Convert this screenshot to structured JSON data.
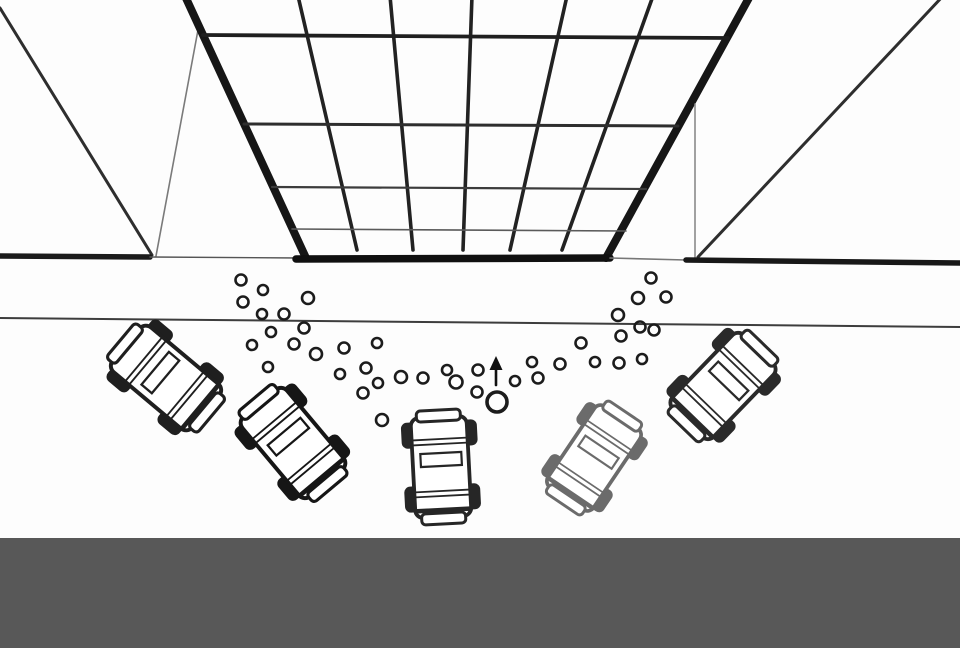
{
  "scene": {
    "background": "#fdfdfd",
    "floor": {
      "name": "floor-band",
      "x": 0,
      "y": 538,
      "w": 960,
      "h": 110,
      "color": "#585858"
    },
    "wall_lines": [
      {
        "name": "left-outer-wall-edge",
        "x1": 0,
        "y1": 8,
        "x2": 152,
        "y2": 255,
        "w": 3,
        "c": "#2e2e2e"
      },
      {
        "name": "left-inner-wall-edge",
        "x1": 198,
        "y1": 30,
        "x2": 156,
        "y2": 256,
        "w": 1.6,
        "c": "#7a7a7a"
      },
      {
        "name": "left-pillar",
        "x1": 185,
        "y1": -4,
        "x2": 306,
        "y2": 258,
        "w": 8,
        "c": "#161616"
      },
      {
        "name": "right-pillar",
        "x1": 750,
        "y1": -4,
        "x2": 606,
        "y2": 258,
        "w": 8,
        "c": "#161616"
      },
      {
        "name": "right-outer-wall-edge",
        "x1": 943,
        "y1": -4,
        "x2": 698,
        "y2": 257,
        "w": 3,
        "c": "#2e2e2e"
      },
      {
        "name": "right-inner-wall-edge",
        "x1": 695,
        "y1": 104,
        "x2": 695,
        "y2": 258,
        "w": 1.6,
        "c": "#8a8a8a"
      }
    ],
    "ceiling_grid": {
      "vertical_style": {
        "w": 3.6,
        "c": "#222222"
      },
      "verticals": [
        [
          298,
          -4,
          357,
          250
        ],
        [
          390,
          -4,
          413,
          250
        ],
        [
          472,
          -4,
          463,
          250
        ],
        [
          567,
          -4,
          510,
          250
        ],
        [
          653,
          -4,
          562,
          250
        ]
      ],
      "horizontals": [
        {
          "name": "ceiling-crossbar-1",
          "x1": 203,
          "y1": 35,
          "x2": 728,
          "y2": 38,
          "w": 3.8,
          "c": "#1f1f1f"
        },
        {
          "name": "ceiling-crossbar-2",
          "x1": 244,
          "y1": 124,
          "x2": 678,
          "y2": 126,
          "w": 3,
          "c": "#2e2e2e"
        },
        {
          "name": "ceiling-crossbar-3",
          "x1": 272,
          "y1": 187,
          "x2": 646,
          "y2": 189,
          "w": 2.2,
          "c": "#3c3c3c"
        },
        {
          "name": "ceiling-crossbar-4",
          "x1": 292,
          "y1": 229,
          "x2": 626,
          "y2": 231,
          "w": 1.6,
          "c": "#5a5a5a"
        }
      ]
    },
    "track_lines": [
      {
        "name": "start-wall-left",
        "x1": 0,
        "y1": 256,
        "x2": 150,
        "y2": 257,
        "w": 5.5,
        "c": "#1b1b1b"
      },
      {
        "name": "start-wall-gap-left",
        "x1": 150,
        "y1": 257,
        "x2": 300,
        "y2": 258,
        "w": 1.4,
        "c": "#555555"
      },
      {
        "name": "grid-base",
        "x1": 296,
        "y1": 259,
        "x2": 610,
        "y2": 258,
        "w": 7.5,
        "c": "#101010"
      },
      {
        "name": "start-wall-gap-right",
        "x1": 610,
        "y1": 258,
        "x2": 686,
        "y2": 260,
        "w": 1.6,
        "c": "#777777"
      },
      {
        "name": "start-wall-right",
        "x1": 686,
        "y1": 260,
        "x2": 960,
        "y2": 263,
        "w": 5.5,
        "c": "#181818"
      },
      {
        "name": "track-edge-line",
        "x1": 0,
        "y1": 318,
        "x2": 960,
        "y2": 327,
        "w": 2,
        "c": "#3d3d3d"
      }
    ],
    "bubbles": {
      "stroke_w": 2.6,
      "color": "#1c1c1c",
      "points": [
        [
          241,
          280,
          5.5
        ],
        [
          263,
          290,
          5
        ],
        [
          243,
          302,
          5.5
        ],
        [
          308,
          298,
          6
        ],
        [
          262,
          314,
          5
        ],
        [
          284,
          314,
          5.5
        ],
        [
          304,
          328,
          5.5
        ],
        [
          271,
          332,
          5
        ],
        [
          252,
          345,
          5
        ],
        [
          294,
          344,
          5.5
        ],
        [
          316,
          354,
          6
        ],
        [
          268,
          367,
          5
        ],
        [
          344,
          348,
          5.5
        ],
        [
          377,
          343,
          5
        ],
        [
          340,
          374,
          5
        ],
        [
          366,
          368,
          5.5
        ],
        [
          378,
          383,
          5
        ],
        [
          363,
          393,
          5.5
        ],
        [
          382,
          420,
          6
        ],
        [
          401,
          377,
          6
        ],
        [
          423,
          378,
          5.5
        ],
        [
          447,
          370,
          5
        ],
        [
          456,
          382,
          6.5
        ],
        [
          478,
          370,
          5.5
        ],
        [
          477,
          392,
          5.5
        ],
        [
          515,
          381,
          5
        ],
        [
          532,
          362,
          5
        ],
        [
          538,
          378,
          5.5
        ],
        [
          560,
          364,
          5.5
        ],
        [
          581,
          343,
          5.5
        ],
        [
          595,
          362,
          5
        ],
        [
          618,
          315,
          6
        ],
        [
          619,
          363,
          5.5
        ],
        [
          621,
          336,
          5.5
        ],
        [
          638,
          298,
          6
        ],
        [
          640,
          327,
          5.5
        ],
        [
          642,
          359,
          5
        ],
        [
          651,
          278,
          5.5
        ],
        [
          654,
          330,
          5.5
        ],
        [
          666,
          297,
          5.5
        ]
      ],
      "big_bubble": {
        "x": 497,
        "y": 402,
        "r": 10,
        "stroke_w": 3.6
      }
    },
    "arrow": {
      "name": "direction-arrow",
      "x": 496,
      "tip_y": 356,
      "head_w": 13,
      "head_h": 14,
      "tail_y": 385,
      "stem_w": 2.6,
      "c": "#111111"
    },
    "car_template": {
      "body": {
        "x": -28,
        "y": -50,
        "w": 56,
        "h": 100,
        "rx": 8,
        "sw": 3.8
      },
      "wheels": [
        [
          -38,
          -46,
          14,
          26
        ],
        [
          24,
          -46,
          14,
          26
        ],
        [
          -38,
          18,
          14,
          26
        ],
        [
          24,
          18,
          14,
          26
        ]
      ],
      "wheel_rx": 6,
      "nose_cap": {
        "x": -22,
        "y": -57,
        "w": 44,
        "h": 11,
        "rx": 4,
        "sw": 3
      },
      "tail_cap": {
        "x": -22,
        "y": 46,
        "w": 44,
        "h": 11,
        "rx": 4,
        "sw": 3
      },
      "windshield_lines": [
        -28,
        -23
      ],
      "rear_lines": [
        24,
        29
      ],
      "line_x": [
        -27,
        27
      ],
      "line_w": 1.8,
      "window": {
        "x": -20,
        "y": -14,
        "w": 41,
        "h": 13,
        "sw": 2.2
      },
      "bumper_line": {
        "y": 43,
        "x1": -26,
        "x2": 26,
        "sw": 4.5
      }
    },
    "cars": [
      {
        "name": "car-1",
        "x": 166,
        "y": 378,
        "rot": -50,
        "scale": 1.04,
        "ink": "#1f1f1f"
      },
      {
        "name": "car-2",
        "x": 293,
        "y": 443,
        "rot": -40,
        "scale": 1.04,
        "ink": "#161616"
      },
      {
        "name": "car-3",
        "x": 441,
        "y": 467,
        "rot": -3,
        "scale": 1.0,
        "ink": "#262626"
      },
      {
        "name": "car-4",
        "x": 594,
        "y": 458,
        "rot": 34,
        "scale": 0.98,
        "ink": "#6b6b6b"
      },
      {
        "name": "car-5",
        "x": 723,
        "y": 386,
        "rot": 44,
        "scale": 1.02,
        "ink": "#2a2a2a"
      }
    ]
  }
}
